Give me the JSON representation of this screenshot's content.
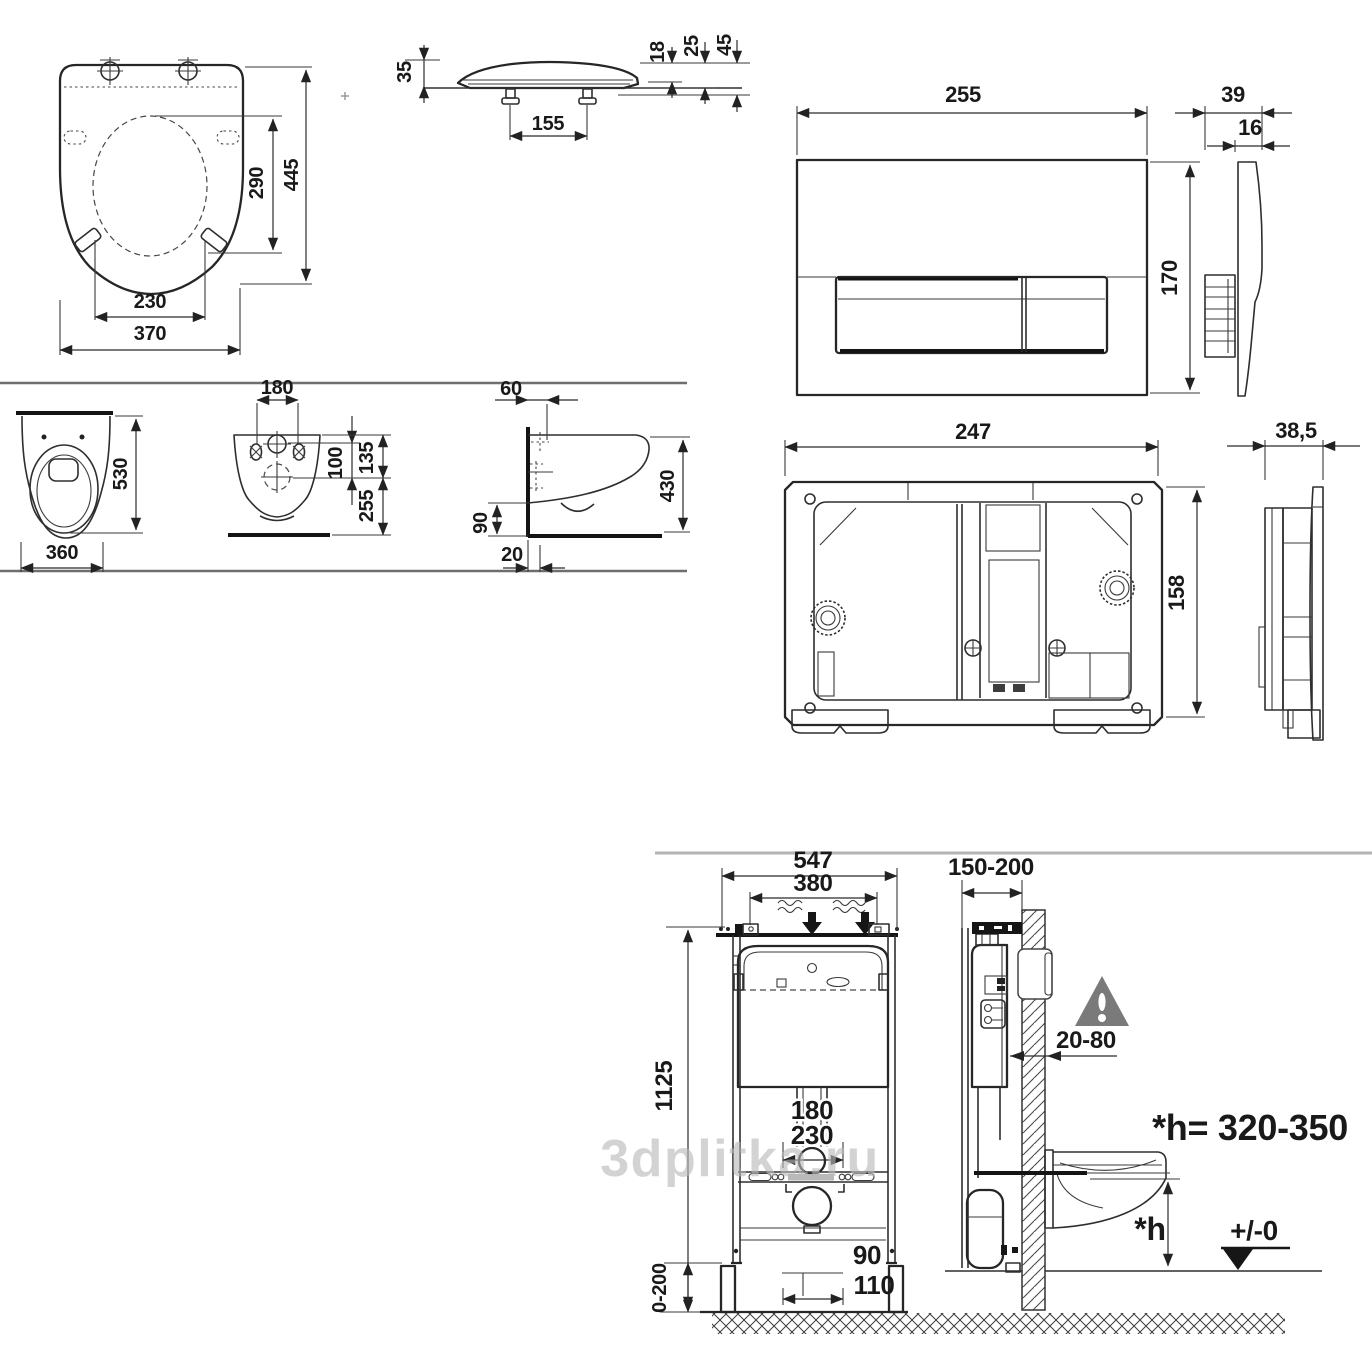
{
  "watermark": {
    "text": "3dplitka.ru"
  },
  "panels": {
    "seat_top": {
      "dims": {
        "depth_total": "445",
        "opening_depth": "290",
        "opening_width": "230",
        "width_total": "370"
      }
    },
    "seat_side": {
      "dims": {
        "height_front": "35",
        "hinge_spacing": "155",
        "thk_rim": "18",
        "thk_mid": "25",
        "height_total": "45"
      }
    },
    "plate_front": {
      "dims": {
        "width": "255",
        "height": "170"
      }
    },
    "plate_side": {
      "dims": {
        "depth_total": "39",
        "depth_plate": "16"
      }
    },
    "bowl_front": {
      "dims": {
        "depth": "530",
        "width": "360"
      }
    },
    "bowl_rear": {
      "dims": {
        "holes_spacing": "180",
        "holes_offset": "100",
        "inlet_offset": "135",
        "outlet_height": "255"
      }
    },
    "bowl_side": {
      "dims": {
        "fixing_offset": "60",
        "depth": "430",
        "bottom_height": "90",
        "gap": "20"
      }
    },
    "frame_front": {
      "dims": {
        "width": "247",
        "height": "158"
      }
    },
    "frame_side": {
      "dims": {
        "depth": "38,5"
      }
    },
    "install_front": {
      "dims": {
        "width_total": "547",
        "width_inner": "380",
        "height": "1125",
        "pipe_180": "180",
        "pipe_230": "230",
        "pipe_90": "90",
        "pipe_110": "110",
        "feet_range": "0-200"
      }
    },
    "install_side": {
      "dims": {
        "wall_range": "150-200",
        "recess_range": "20-80",
        "height_note": "*h= 320-350",
        "h_label": "*h",
        "datum": "+/-0"
      }
    }
  }
}
